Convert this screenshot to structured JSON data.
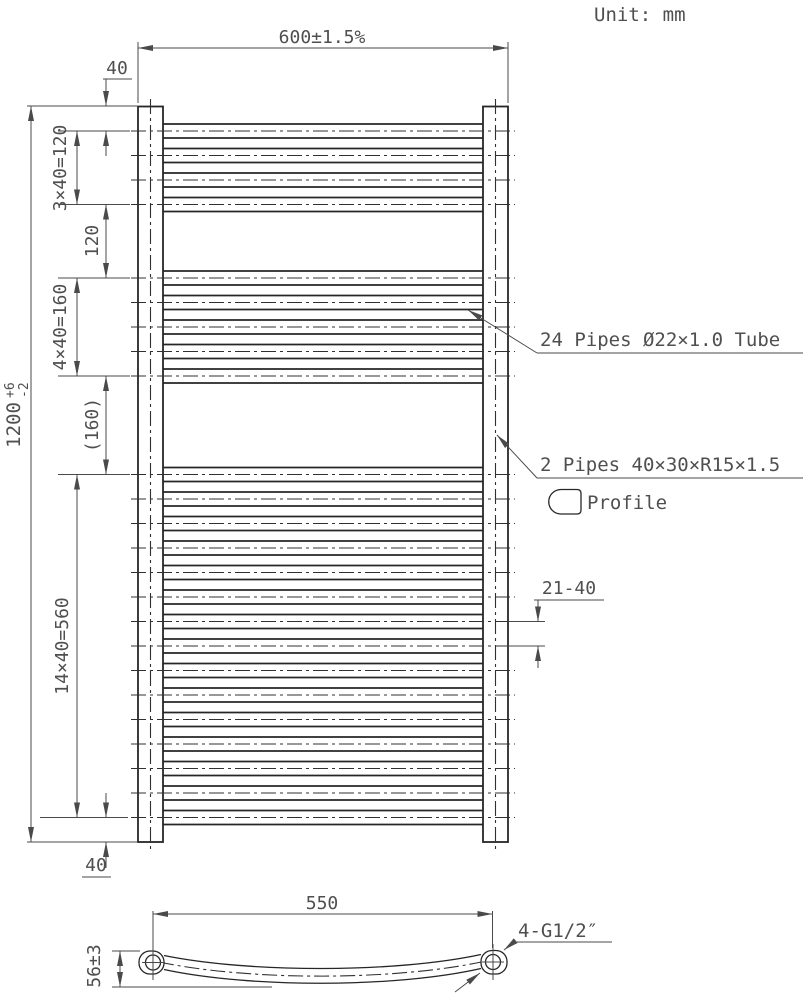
{
  "unit_note": "Unit: mm",
  "dimensions": {
    "overall_width": "600±1.5%",
    "overall_height": {
      "value": "1200",
      "tol_plus": "+6",
      "tol_minus": "-2"
    },
    "top_offset": "40",
    "group1_pitch": "3×40=120",
    "gap1": "120",
    "group2_pitch": "4×40=160",
    "gap2": "(160)",
    "group3_pitch": "14×40=560",
    "bottom_offset": "40",
    "pipe_spacing_note": "21-40",
    "connection_spacing": "550",
    "bow_depth": "56±3"
  },
  "labels": {
    "pipes_note": "24 Pipes Ø22×1.0 Tube",
    "posts_note": "2 Pipes 40×30×R15×1.5",
    "profile": "Profile",
    "connections": "4-G1/2″"
  },
  "drawing": {
    "pipe_count": 24,
    "pipe_groups": [
      {
        "count": 4
      },
      {
        "count": 5
      },
      {
        "count": 15
      }
    ],
    "pipe_pitch_mm": 40,
    "post_count": 2,
    "colors": {
      "line": "#262626",
      "dim": "#4a4a4a",
      "text": "#4f4f4f",
      "background": "#ffffff"
    }
  }
}
